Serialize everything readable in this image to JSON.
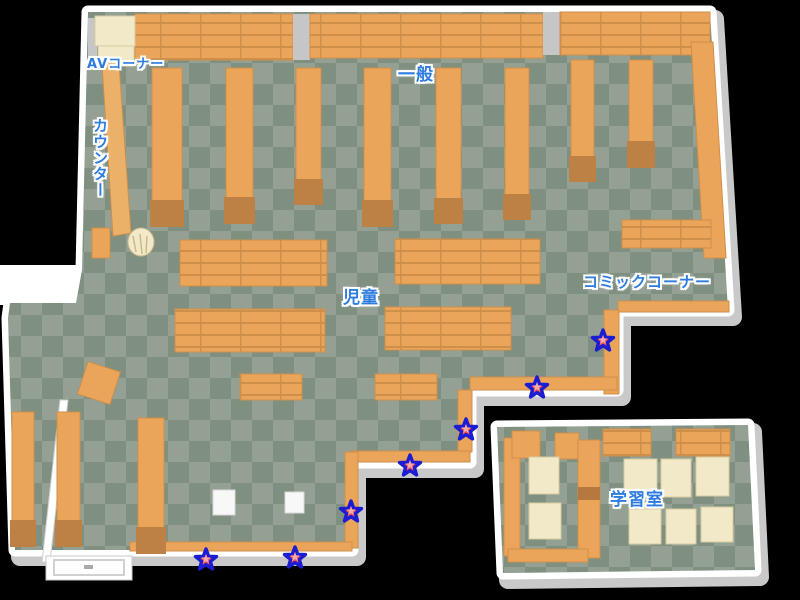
{
  "labels": {
    "av_corner": "AVコーナー",
    "general": "一般",
    "counter": "カウンター",
    "children": "児童",
    "comic_corner": "コミックコーナー",
    "study_room": "学習室"
  },
  "markers": {
    "shape": "star",
    "fill": "#ee4f4f",
    "highlight": "#f9a8a8",
    "outline": "#1c1cd2",
    "positions": [
      {
        "x": 206,
        "y": 560
      },
      {
        "x": 295,
        "y": 558
      },
      {
        "x": 351,
        "y": 512
      },
      {
        "x": 410,
        "y": 466
      },
      {
        "x": 466,
        "y": 430
      },
      {
        "x": 537,
        "y": 388
      },
      {
        "x": 603,
        "y": 341
      }
    ]
  },
  "colors": {
    "background": "#000000",
    "wall": "#ffffff",
    "wall_shadow": "#c9c9c9",
    "floor_dark": "#7f8f80",
    "floor_light": "#93a093",
    "shelf": "#eaa55b",
    "shelf_edge": "#ce8f4b",
    "shelf_base": "#bd8045",
    "furniture_cream": "#f2e9c9",
    "label_text": "#2e7ce0",
    "label_outline": "#ffffff"
  }
}
